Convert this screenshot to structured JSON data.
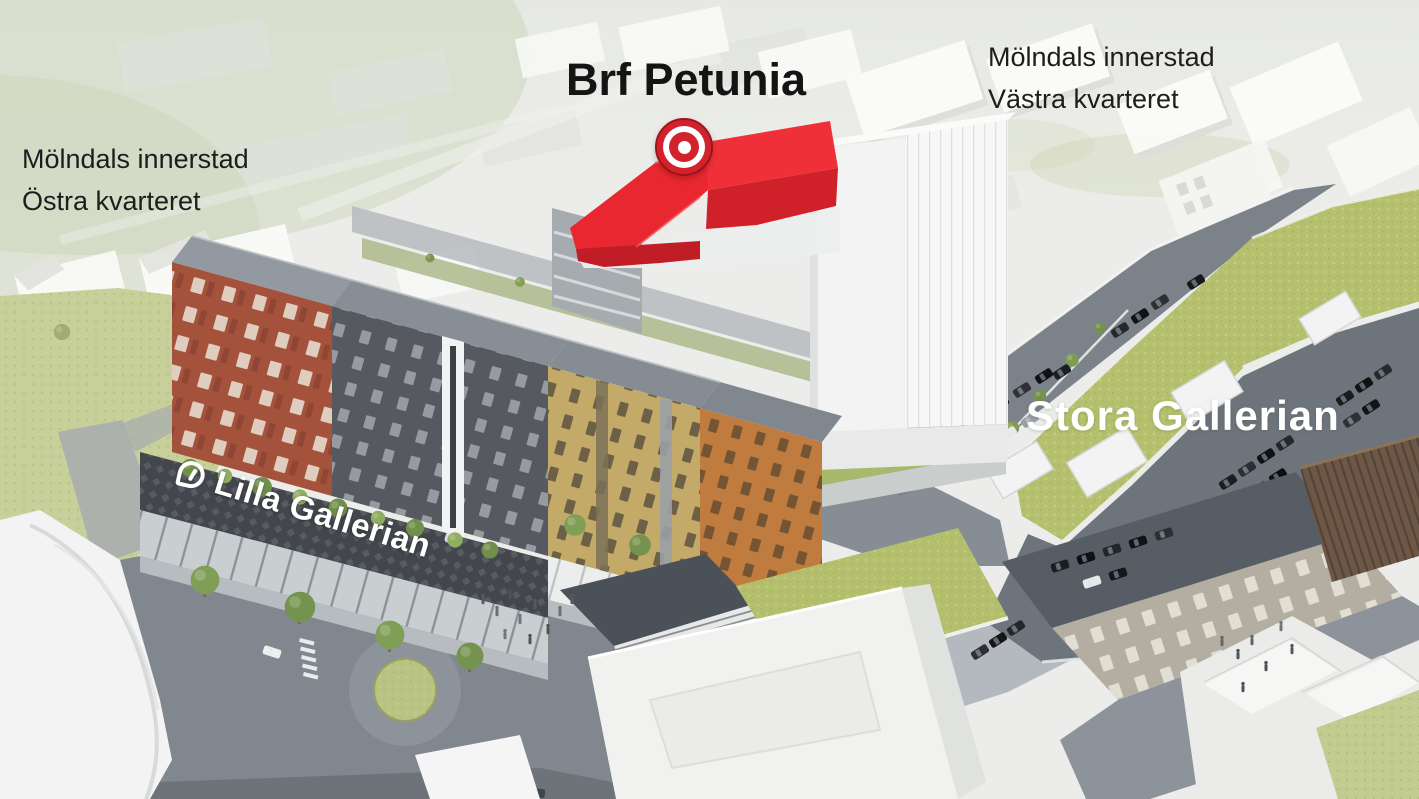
{
  "scene": {
    "type": "aerial-architectural-rendering",
    "description": "Development overview of Mölndals innerstad with highlighted Brf Petunia building"
  },
  "labels": {
    "project_title": "Brf Petunia",
    "district_west": {
      "line1": "Mölndals innerstad",
      "line2": "Västra kvarteret"
    },
    "district_east": {
      "line1": "Mölndals innerstad",
      "line2": "Östra kvarteret"
    },
    "mall_large": "Stora Gallerian",
    "mall_small": "Lilla Gallerian"
  },
  "icons": {
    "location_marker": "bullseye-target",
    "lilla_gallerian_logo": "speech-bubble-leaf"
  },
  "colors": {
    "highlight_red": "#e8252c",
    "marker_red": "#d2222b",
    "label_text_dark": "#1c1c1c",
    "label_text_light": "#ffffff",
    "green_roof": "#b5c06f",
    "asphalt": "#81878f",
    "brick_red": "#a5523d",
    "facade_dark_gray": "#565a60",
    "facade_yellow": "#c3aa69",
    "facade_orange": "#bf7c3e",
    "podium_dark": "#43474d",
    "white_building": "#f2f3f2"
  }
}
